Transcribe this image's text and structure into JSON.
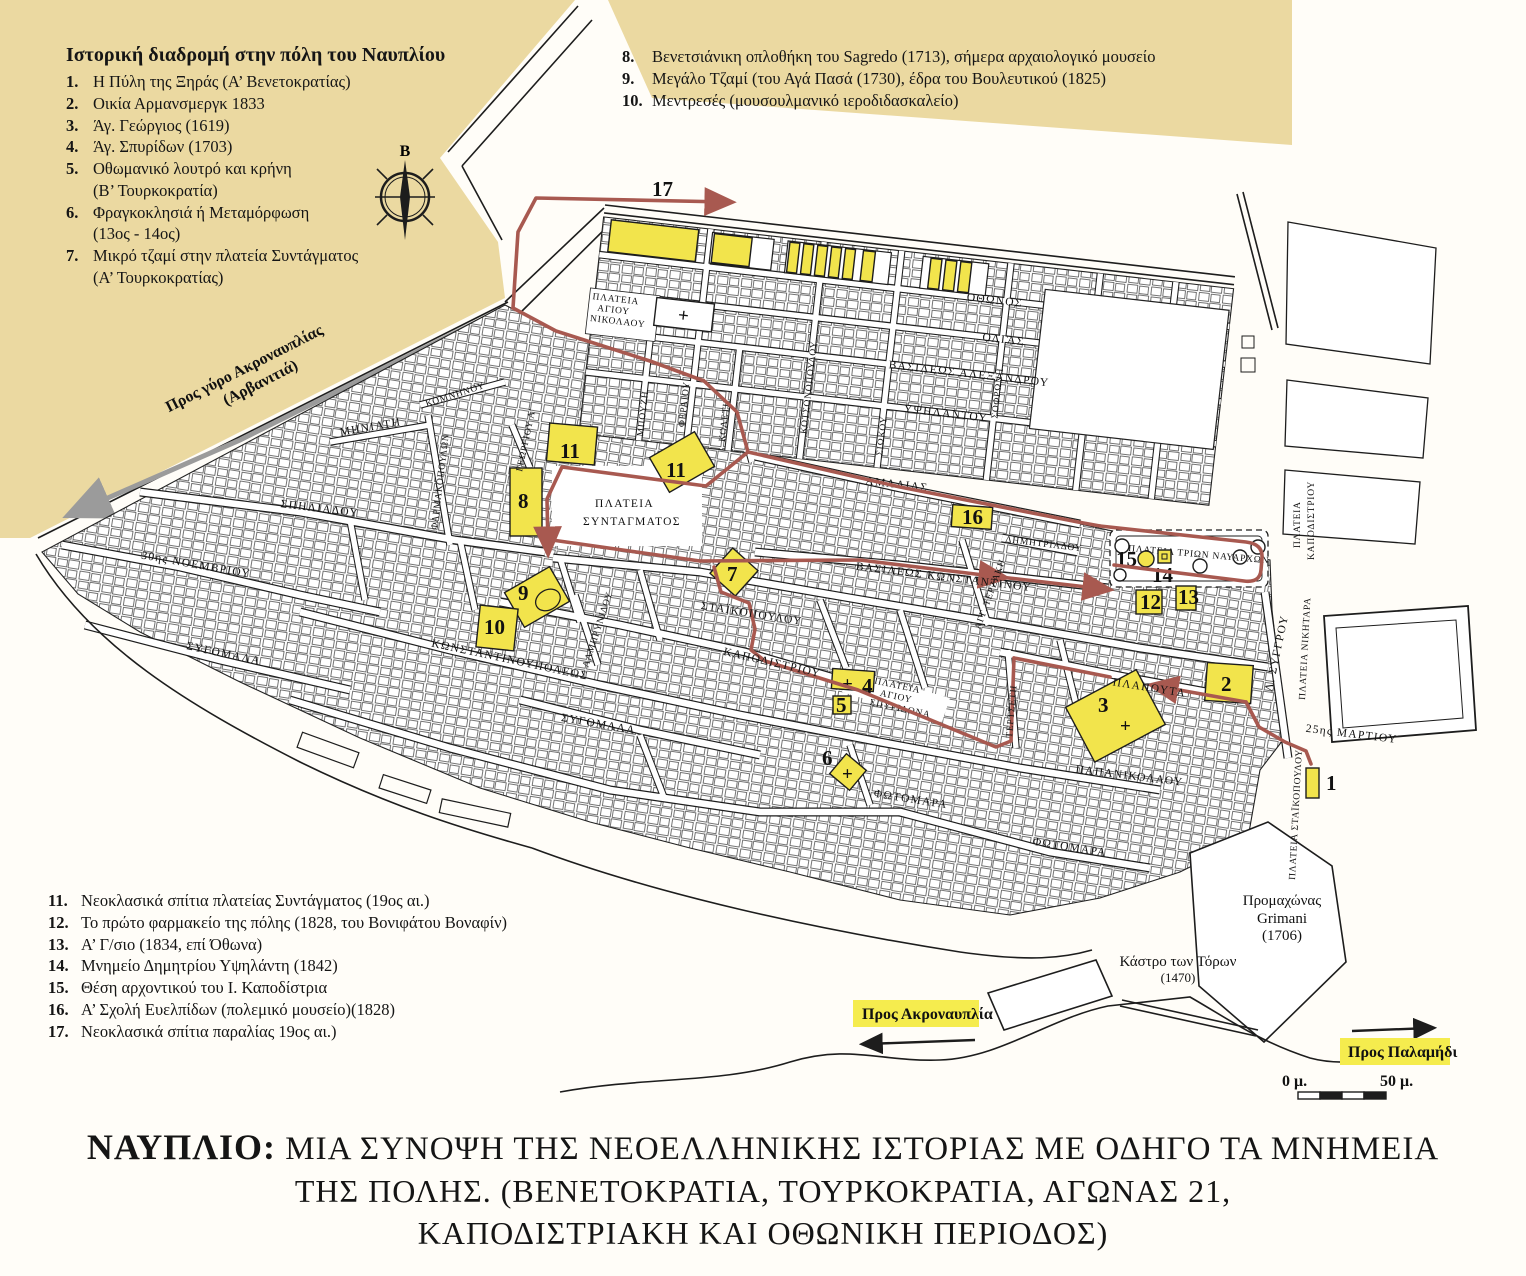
{
  "colors": {
    "beige": "#ebd9a1",
    "yellow": "#f2e44c",
    "route_red": "#a85950",
    "route_grey": "#9b9b9b",
    "ink": "#1d1d1d"
  },
  "legend_top_left": {
    "title": "Ιστορική διαδρομή στην πόλη του Ναυπλίου",
    "items": [
      {
        "num": "1.",
        "text": "Η Πύλη της Ξηράς (Α’ Βενετοκρατίας)"
      },
      {
        "num": "2.",
        "text": "Οικία Αρμανσμεργκ 1833"
      },
      {
        "num": "3.",
        "text": "Άγ. Γεώργιος (1619)"
      },
      {
        "num": "4.",
        "text": "Άγ. Σπυρίδων (1703)"
      },
      {
        "num": "5.",
        "text": "Οθωμανικό λουτρό και κρήνη\n(Β’ Τουρκοκρατία)"
      },
      {
        "num": "6.",
        "text": "Φραγκοκλησιά ή Μεταμόρφωση\n(13ος - 14ος)"
      },
      {
        "num": "7.",
        "text": "Μικρό τζαμί στην πλατεία Συντάγματος\n(Α’ Τουρκοκρατίας)"
      }
    ]
  },
  "legend_top_right": {
    "items": [
      {
        "num": "8.",
        "text": "Βενετσιάνικη οπλοθήκη του Sagredo (1713), σήμερα αρχαιολογικό μουσείο"
      },
      {
        "num": "9.",
        "text": "Μεγάλο Τζαμί (του Αγά Πασά (1730), έδρα του Βουλευτικού (1825)"
      },
      {
        "num": "10.",
        "text": "Μεντρεσές (μουσουλμανικό ιεροδιδασκαλείο)"
      }
    ]
  },
  "legend_bottom_left": {
    "items": [
      {
        "num": "11.",
        "text": "Νεοκλασικά σπίτια πλατείας Συντάγματος (19ος αι.)"
      },
      {
        "num": "12.",
        "text": "Το πρώτο φαρμακείο της πόλης (1828, του Βονιφάτου Βοναφίν)"
      },
      {
        "num": "13.",
        "text": "Α’ Γ/σιο (1834, επί Όθωνα)"
      },
      {
        "num": "14.",
        "text": "Μνημείο Δημητρίου Υψηλάντη (1842)"
      },
      {
        "num": "15.",
        "text": "Θέση αρχοντικού του Ι. Καποδίστρια"
      },
      {
        "num": "16.",
        "text": "Α’ Σχολή Ευελπίδων (πολεμικό μουσείο)(1828)"
      },
      {
        "num": "17.",
        "text": "Νεοκλασικά σπίτια παραλίας 19ος αι.)"
      }
    ]
  },
  "title": {
    "line1_prefix": "ΝΑΥΠΛΙΟ:",
    "line1_rest": " ΜΙΑ ΣΥΝΟΨΗ ΤΗΣ ΝΕΟΕΛΛΗΝΙΚΗΣ  ΙΣΤΟΡΙΑΣ ΜΕ ΟΔΗΓΟ ΤΑ ΜΝΗΜΕΙΑ",
    "line2": "ΤΗΣ ΠΟΛΗΣ. (ΒΕΝΕΤΟΚΡΑΤΙΑ, ΤΟΥΡΚΟΚΡΑΤΙΑ, ΑΓΩΝΑΣ 21,",
    "line3": "ΚΑΠΟΔΙΣΤΡΙΑΚΗ ΚΑΙ ΟΘΩΝΙΚΗ ΠΕΡΙΟΔΟΣ)"
  },
  "map": {
    "compass_north": "Β",
    "route17": "17",
    "symbols": {
      "cross": "+"
    },
    "markers": {
      "m1": "1",
      "m2": "2",
      "m3": "3",
      "m4": "4",
      "m5": "5",
      "m6": "6",
      "m7": "7",
      "m8": "8",
      "m9": "9",
      "m10": "10",
      "m11": "11",
      "m12": "12",
      "m13": "13",
      "m14": "14",
      "m15": "15",
      "m16": "16"
    },
    "streets": {
      "othonos": "ΟΘΩΝΟΣ",
      "olgas": "ΟΛΓΑΣ",
      "vas_alexandrou": "ΒΑΣΙΛΕΩΣ ΑΛΕΞΑΝΔΡΟΥ",
      "ypsilantou": "ΥΨΗΛΑΝΤΟΥ",
      "amalias": "ΑΜΑΛΙΑΣ",
      "bouzi": "ΜΠΟΥΖΗ",
      "fereou": "ΦΕΡΑΙΟΥ",
      "koleti": "ΚΟΛΕΤΗ",
      "kotsonopoulou": "ΚΟΤΣΟΝΟΠΟΥΛΟΥ",
      "siokou": "ΣΙΩΚΟΥ",
      "sofroni": "ΣΟΦΡΩΝΗ",
      "georgiou_a": "ΓΕΩΡΓΙΟΥ Α’",
      "farmakopoulon": "ΦΑΡΜΑΚΟΠΟΥΛΩΝ",
      "komninou": "ΚΟΜΝΗΝΟΥ",
      "miniati": "ΜΗΝΙΑΤΗ",
      "spiliadou": "ΣΠΗΛΙΑΔΟΥ",
      "noemvriou": "30ης ΝΟΕΜΒΡΙΟΥ",
      "sygomala": "ΣΥΓΟΜΑΛΑ",
      "konstantinoupoleos": "ΚΩΝΣΤΑΝΤΙΝΟΥΠΟΛΕΩΣ",
      "staikopoulou": "ΣΤΑΪΚΟΠΟΥΛΟΥ",
      "kapodistriou": "ΚΑΠΟΔΙΣΤΡΙΟΥ",
      "lamprynidou": "ΛΑΜΠΡΥΝΙΔΟΥ",
      "terzaki": "ΑΓΓ. ΤΕΡΖΑΚΗ",
      "vas_konstantinou": "ΒΑΣΙΛΕΩΣ ΚΩΝΣΤΑΝΤΙΝΟΥ",
      "dimitriadou": "ΔΗΜΗΤΡΙΑΔΟΥ",
      "tertseti": "ΤΕΡΤΣΕΤΗ",
      "plapouta": "ΠΛΑΠΟΥΤΑ",
      "papanikolaou": "ΠΑΠΑΝΙΚΟΛΑΟΥ",
      "fotomara": "ΦΩΤΟΜΑΡΑ",
      "martiou": "25ης ΜΑΡΤΙΟΥ",
      "syngrou": "Λ. ΣΥΓΓΡΟΥ"
    },
    "squares": {
      "agiou_nikolaou": [
        "ΠΛΑΤΕΙΑ",
        "ΑΓΙΟΥ",
        "ΝΙΚΟΛΑΟΥ"
      ],
      "syntagmatos": [
        "ΠΛΑΤΕΙΑ",
        "ΣΥΝΤΑΓΜΑΤΟΣ"
      ],
      "trion_navarchon": "ΠΛΑΤΕΙΑ ΤΡΙΩΝ ΝΑΥΑΡΧΩΝ",
      "agiou_spyridona": [
        "ΠΛΑΤΕΙΑ",
        "ΑΓΙΟΥ",
        "ΣΠΥΡΙΔΩΝΑ"
      ],
      "kapodistriou": [
        "ΠΛΑΤΕΙΑ",
        "ΚΑΠΟΔΙΣΤΡΙΟΥ"
      ],
      "nikitara": "ΠΛΑΤΕΙΑ ΝΙΚΗΤΑΡΑ",
      "staikopoulou": "ΠΛΑΤΕΙΑ ΣΤΑΪΚΟΠΟΥΛΟΥ"
    },
    "labels": {
      "pros_gyro1": "Προς γύρο Ακροναυπλίας",
      "pros_gyro2": "(Αρβανιτιά)",
      "pros_akronafplia": "Προς Ακροναυπλία",
      "pros_palamidi": "Προς Παλαμήδι",
      "promachonas": [
        "Προμαχώνας",
        "Grimani",
        "(1706)"
      ],
      "kastro": [
        "Κάστρο των Τόρων",
        "(1470)"
      ],
      "scale0": "0 μ.",
      "scale50": "50 μ."
    }
  }
}
